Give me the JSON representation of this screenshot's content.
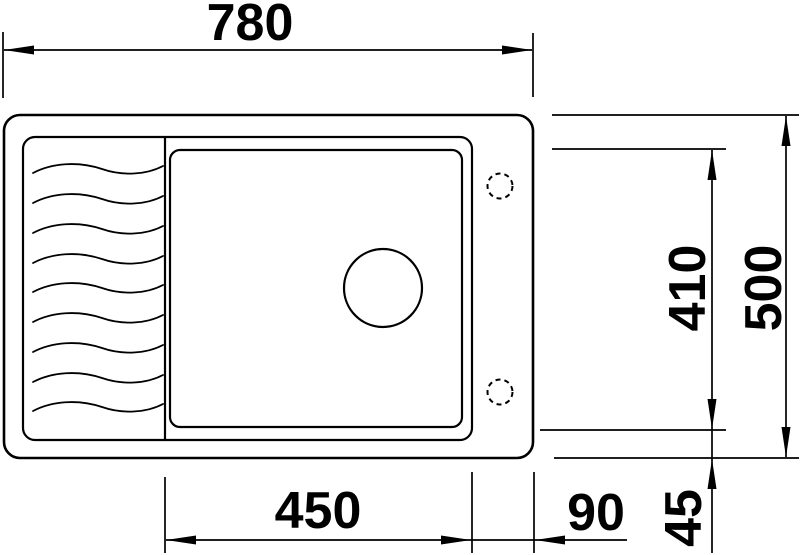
{
  "drawing": {
    "type_label": "sink-top-view-technical-drawing",
    "dimensions": {
      "overall_width": "780",
      "overall_depth": "500",
      "bowl_width": "450",
      "bowl_depth": "410",
      "right_offset": "90",
      "bottom_offset": "45"
    },
    "features": {
      "drainboard_ridge_count": 9,
      "tap_hole_count": 2,
      "drain_hole_count": 1
    },
    "colors": {
      "line": "#000000",
      "background": "#ffffff"
    }
  }
}
